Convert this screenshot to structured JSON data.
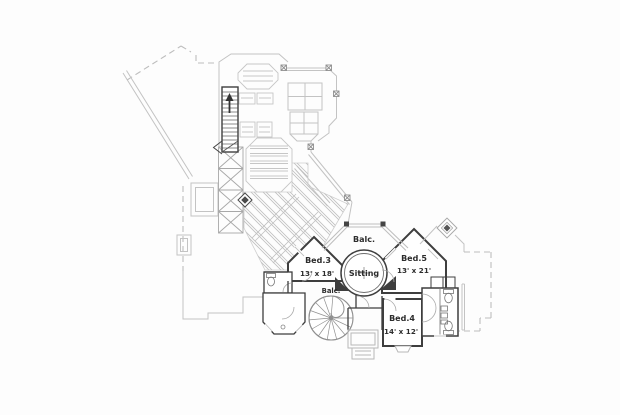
{
  "plan": {
    "type": "floor-plan",
    "rooms": [
      {
        "id": "balcony-upper",
        "label": "Balc.",
        "dims": ""
      },
      {
        "id": "bed-3",
        "label": "Bed.3",
        "dims": "13' x 18'"
      },
      {
        "id": "sitting",
        "label": "Sitting",
        "dims": ""
      },
      {
        "id": "bed-5",
        "label": "Bed.5",
        "dims": "13' x 21'"
      },
      {
        "id": "balcony-lower",
        "label": "Balc.",
        "dims": ""
      },
      {
        "id": "bed-4",
        "label": "Bed.4",
        "dims": "14' x 12'"
      }
    ],
    "features": [
      "dashed-roof-outline",
      "staircase",
      "spiral-staircase",
      "hatched-deck",
      "terrace-furniture",
      "balcony-railing",
      "chimney",
      "bathroom-fixtures",
      "x-brace-pillars",
      "diamond-marker"
    ],
    "colors": {
      "background": "#fdfdfd",
      "wall_dark": "#3e3e3e",
      "line_light": "#c3c3c3",
      "line_mid": "#989898",
      "dashed_roof": "#bdbdbd",
      "text": "#2d2d2d"
    }
  }
}
